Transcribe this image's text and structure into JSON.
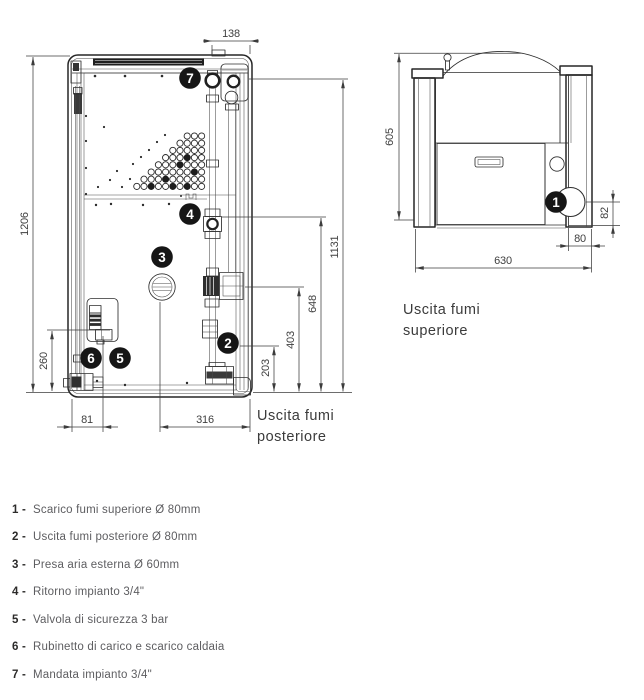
{
  "colors": {
    "line": "#2e2e2e",
    "dim_text": "#3f3f3f",
    "legend_text": "#5d5d60",
    "legend_num": "#2c2b2a",
    "callout_bg": "#161616"
  },
  "views": {
    "rear": {
      "dims": {
        "total_height": "1206",
        "flue_top_offset": "138",
        "flow_connection_height": "1131",
        "return_connection_height": "648",
        "pump_height": "403",
        "rear_flue_height": "203",
        "safety_valve_height": "260",
        "drain_offset": "81",
        "air_intake_offset": "316"
      },
      "label": {
        "line1": "Uscita fumi",
        "line2": "posteriore"
      }
    },
    "top": {
      "dims": {
        "depth": "605",
        "width": "630",
        "flue_rear_offset": "82",
        "flue_side_offset": "80"
      },
      "label": {
        "line1": "Uscita fumi",
        "line2": "superiore"
      }
    }
  },
  "callouts": {
    "c1": "1",
    "c2": "2",
    "c3": "3",
    "c4": "4",
    "c5": "5",
    "c6": "6",
    "c7": "7"
  },
  "legend": {
    "items": [
      {
        "num": "1 -",
        "text": "Scarico fumi superiore Ø 80mm"
      },
      {
        "num": "2 -",
        "text": "Uscita fumi posteriore Ø 80mm"
      },
      {
        "num": "3 -",
        "text": "Presa aria esterna Ø 60mm"
      },
      {
        "num": "4 -",
        "text": "Ritorno impianto 3/4\""
      },
      {
        "num": "5 -",
        "text": "Valvola di sicurezza 3 bar"
      },
      {
        "num": "6 -",
        "text": "Rubinetto di carico e scarico caldaia"
      },
      {
        "num": "7 -",
        "text": "Mandata impianto 3/4\""
      }
    ]
  }
}
